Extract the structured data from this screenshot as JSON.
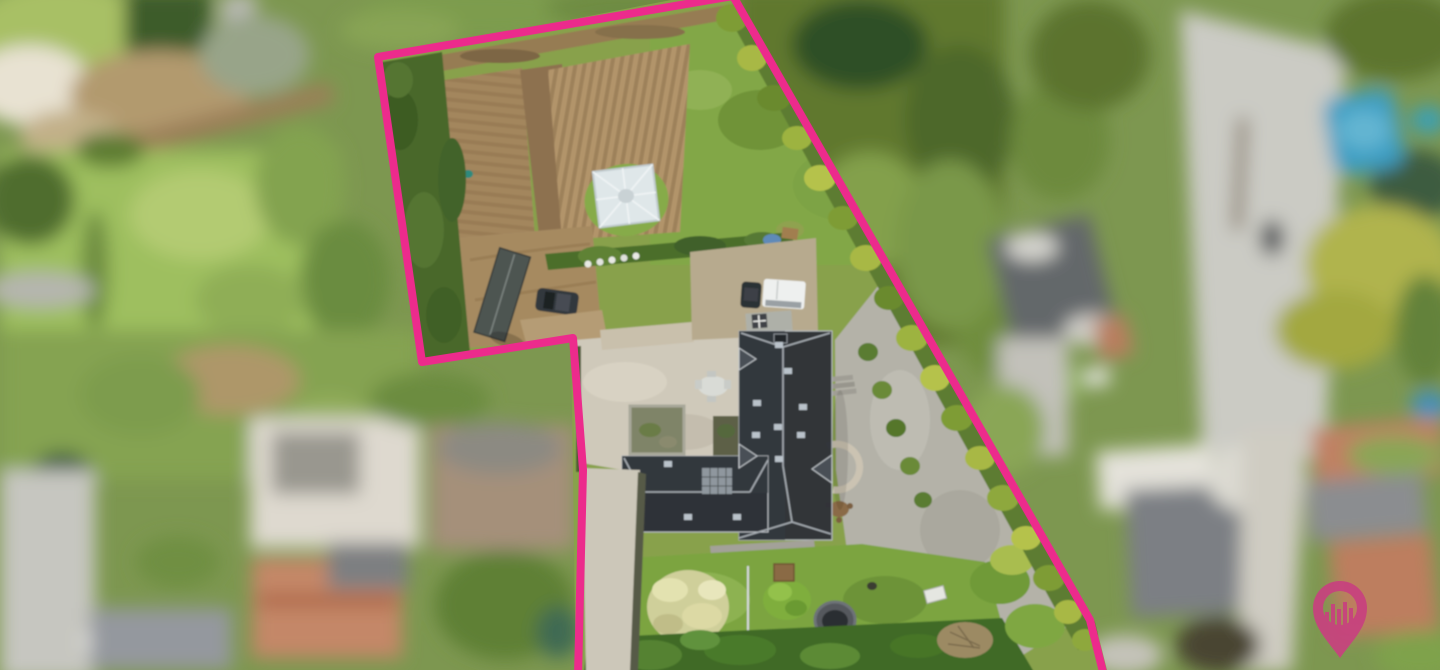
{
  "window": {
    "width": 1440,
    "height": 670
  },
  "photo": {
    "kind": "aerial-drone-photograph",
    "subject": "residential property with large garden outlined for a real-estate listing",
    "privacy_treatment": "all neighbouring parcels and streets are blurred; only the listed parcel is sharp",
    "parcel_features": [
      "tilled vegetable plots with furrows",
      "small white greenhouse",
      "dense boundary hedges",
      "garden shed with grey roof",
      "parked dark car and white camper van",
      "long concrete driveway",
      "large black hipped-roof house with skylights",
      "walled courtyard ruin",
      "white garden table with chairs",
      "gravel paths and semicircular stone wall",
      "lawn with blossoming tree",
      "trampoline",
      "wood pile and blue slide",
      "tall hedge along lower edge"
    ],
    "surroundings_features": [
      "blurred neighbouring houses with orange and grey roofs",
      "blurred street at right",
      "blurred blue pool tarp",
      "blurred lawns, hedges and trees",
      "blurred road and white car at lower left"
    ]
  },
  "annotations": {
    "boundary": {
      "color": "#EC2B8C",
      "stroke_width": 8,
      "points": "578,676 583,470 573,338 422,362 378,57 733,-4 1090,620 1104,676"
    },
    "logo": {
      "name": "map-pin-with-skyline-bars",
      "color": "#C8417F",
      "opacity": 0.92,
      "position": "bottom-right"
    }
  },
  "palette": {
    "grass": "#82a746",
    "lawn_pale": "#9ebf5f",
    "soil": "#a68a60",
    "soil_furrowed": "#b2946a",
    "hedge_dark": "#49682c",
    "hedge_yellow": "#a8b845",
    "roof_black": "#2f3338",
    "roof_trim": "#b9bec3",
    "concrete": "#cfc9ba",
    "gravel": "#b4b2a8",
    "road_blur": "#cbcbc4",
    "orange_roof_blur": "#c08163",
    "grey_roof_blur": "#7e8287",
    "pool_blue_blur": "#3e9ec3"
  }
}
